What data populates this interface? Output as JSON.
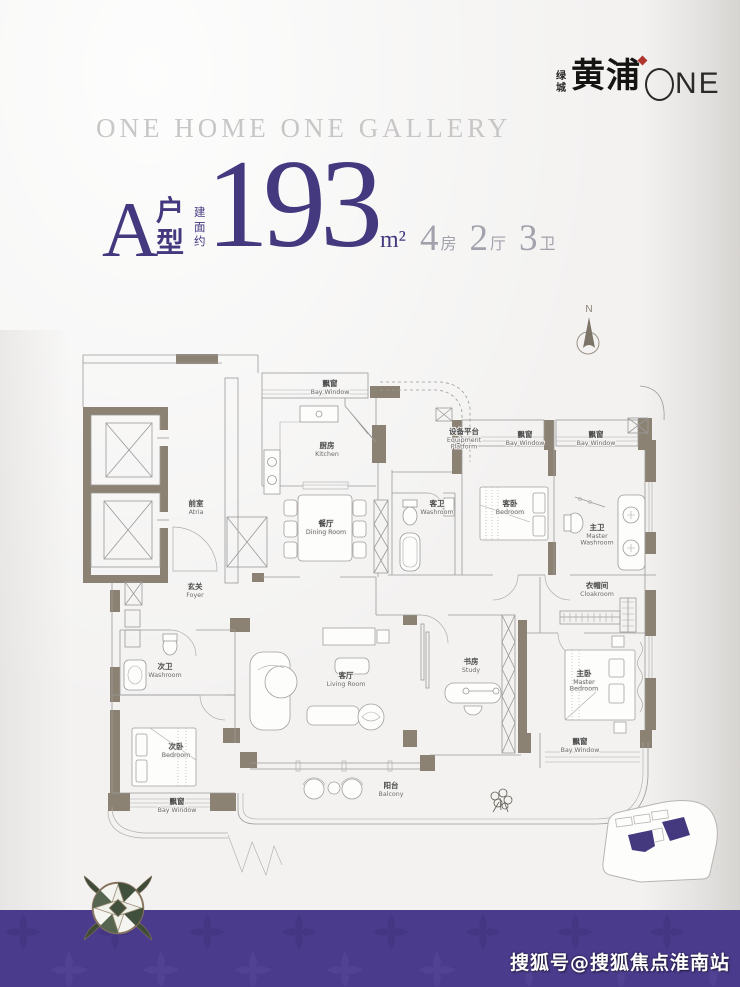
{
  "theme": {
    "accent": "#44387f",
    "spec_color": "#a3a1ac",
    "wall_color": "#8c8273",
    "band_color": "#4b3b8d",
    "logo_accent": "#b0352f"
  },
  "brand": {
    "prefix_chars": [
      "绿",
      "城"
    ],
    "main": "黄浦",
    "circle_letter": "O",
    "suffix": "NE"
  },
  "tagline": "ONE HOME ONE GALLERY",
  "unit": {
    "letter": "A",
    "type_chars": [
      "户",
      "型"
    ],
    "area_prefix_chars": [
      "建",
      "面",
      "约"
    ],
    "area_value": "193",
    "area_unit": "m²",
    "specs": [
      {
        "value": "4",
        "label": "房"
      },
      {
        "value": "2",
        "label": "厅"
      },
      {
        "value": "3",
        "label": "卫"
      }
    ]
  },
  "compass": {
    "label": "N"
  },
  "floorplan": {
    "rooms": [
      {
        "zh": "前室",
        "en": [
          "Atria"
        ],
        "x": 196,
        "y": 216
      },
      {
        "zh": "飘窗",
        "en": [
          "Bay Window"
        ],
        "x": 330,
        "y": 96
      },
      {
        "zh": "厨房",
        "en": [
          "Kitchen"
        ],
        "x": 327,
        "y": 158
      },
      {
        "zh": "设备平台",
        "en": [
          "Equipment",
          "Platform"
        ],
        "x": 464,
        "y": 144
      },
      {
        "zh": "餐厅",
        "en": [
          "Dining Room"
        ],
        "x": 326,
        "y": 236
      },
      {
        "zh": "客卫",
        "en": [
          "Washroom"
        ],
        "x": 437,
        "y": 216
      },
      {
        "zh": "飘窗",
        "en": [
          "Bay Window"
        ],
        "x": 525,
        "y": 147
      },
      {
        "zh": "客卧",
        "en": [
          "Bedroom"
        ],
        "x": 510,
        "y": 216
      },
      {
        "zh": "飘窗",
        "en": [
          "Bay Window"
        ],
        "x": 596,
        "y": 147
      },
      {
        "zh": "主卫",
        "en": [
          "Master",
          "Washroom"
        ],
        "x": 597,
        "y": 240
      },
      {
        "zh": "衣帽间",
        "en": [
          "Cloakroom"
        ],
        "x": 597,
        "y": 298
      },
      {
        "zh": "玄关",
        "en": [
          "Foyer"
        ],
        "x": 195,
        "y": 299
      },
      {
        "zh": "次卫",
        "en": [
          "Washroom"
        ],
        "x": 165,
        "y": 379
      },
      {
        "zh": "客厅",
        "en": [
          "Living Room"
        ],
        "x": 346,
        "y": 388
      },
      {
        "zh": "书房",
        "en": [
          "Study"
        ],
        "x": 471,
        "y": 374
      },
      {
        "zh": "主卧",
        "en": [
          "Master",
          "Bedroom"
        ],
        "x": 584,
        "y": 386
      },
      {
        "zh": "次卧",
        "en": [
          "Bedroom"
        ],
        "x": 176,
        "y": 459
      },
      {
        "zh": "飘窗",
        "en": [
          "Bay Window"
        ],
        "x": 177,
        "y": 514
      },
      {
        "zh": "飘窗",
        "en": [
          "Bay Window"
        ],
        "x": 580,
        "y": 454
      },
      {
        "zh": "阳台",
        "en": [
          "Balcony"
        ],
        "x": 391,
        "y": 498
      }
    ]
  },
  "footer": {
    "watermark": "搜狐号@搜狐焦点淮南站"
  }
}
